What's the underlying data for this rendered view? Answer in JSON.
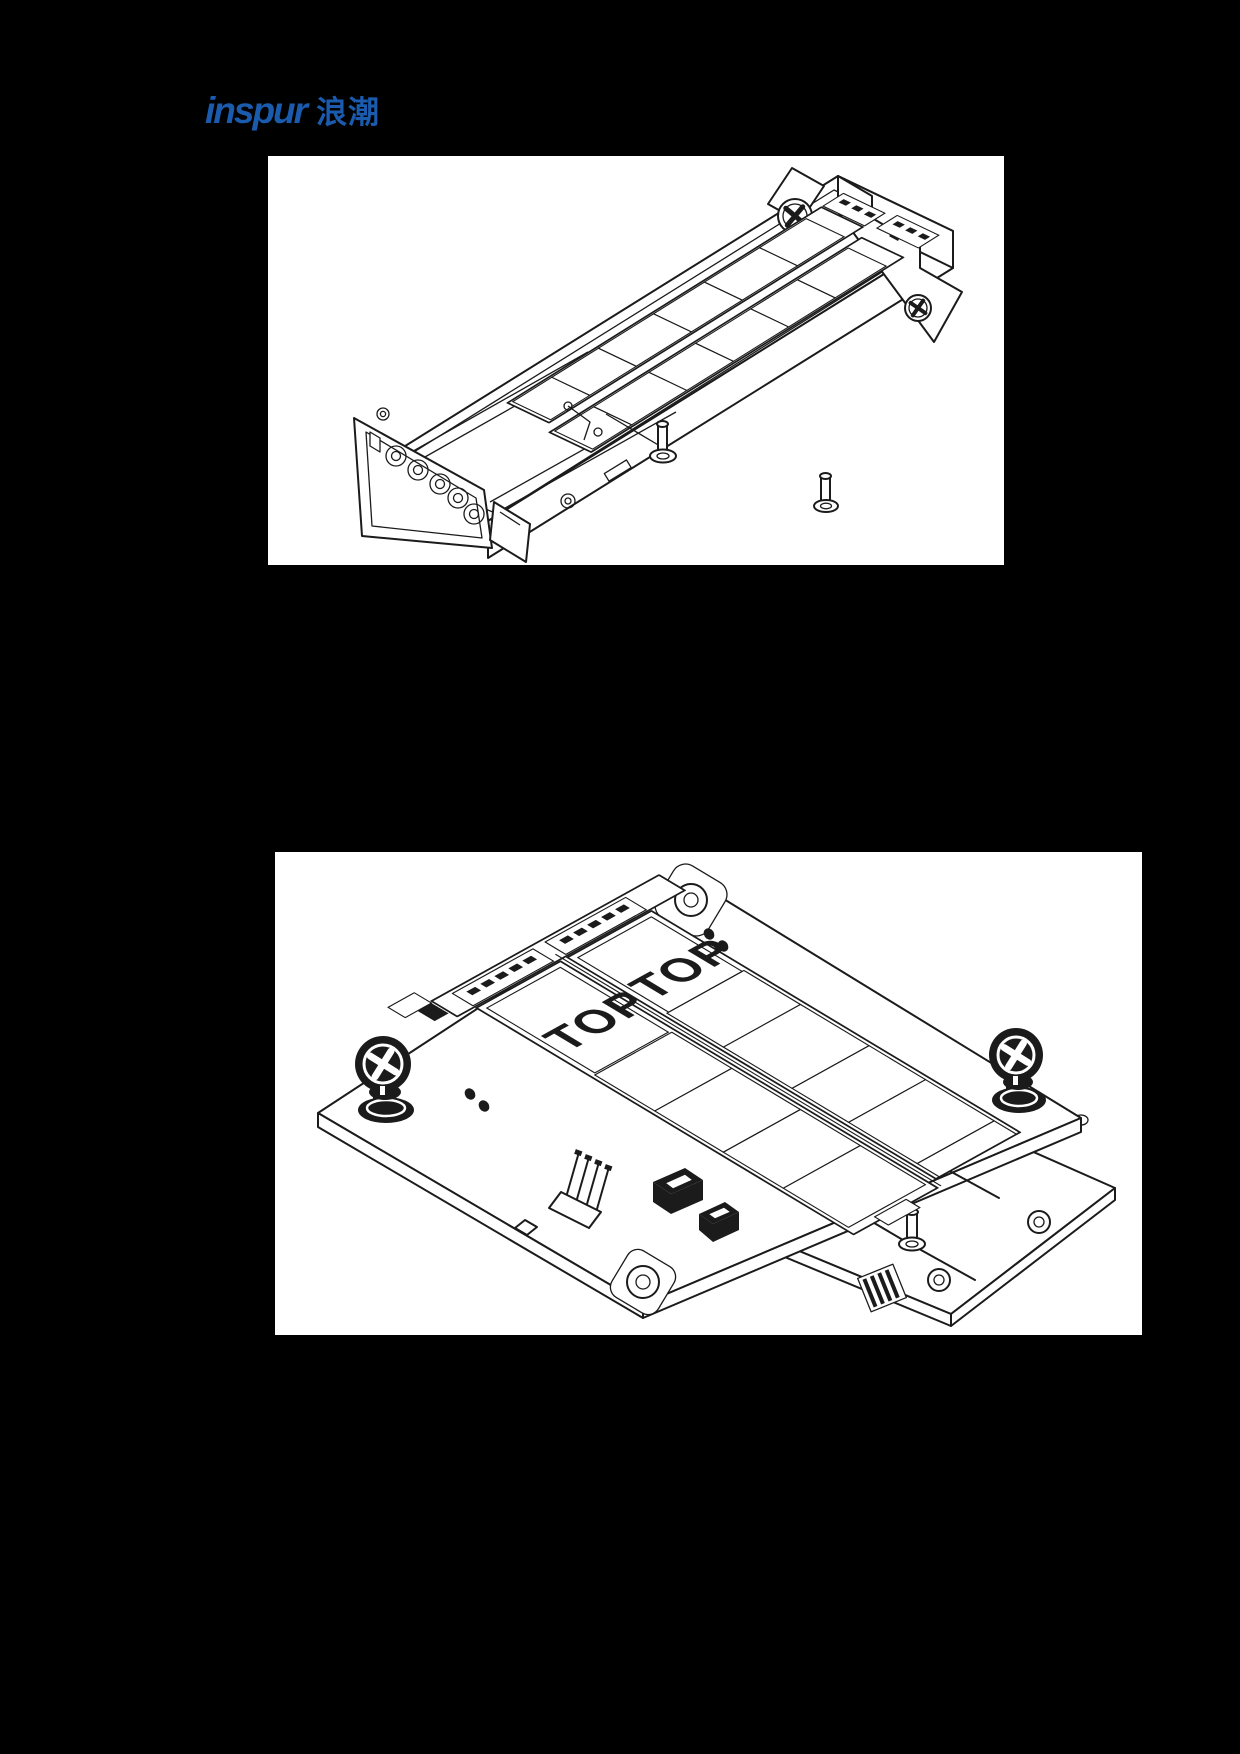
{
  "page": {
    "background_color": "#000000",
    "kind": "hardware manual page with two technical figures"
  },
  "logo": {
    "brand": "inspur",
    "brand_cn": "浪潮",
    "color": "#1a5bad"
  },
  "figure1": {
    "name": "E1.S SSD carrier tray - isometric line drawing",
    "background": "#ffffff",
    "line_color": "#1b1b1b"
  },
  "figure2": {
    "name": "SSD adapter board with heatsinks and thumbscrews - isometric line drawing",
    "background": "#ffffff",
    "line_color": "#1b1b1b",
    "labels": {
      "ssd1": "TOP",
      "ssd2": "TOP"
    }
  }
}
